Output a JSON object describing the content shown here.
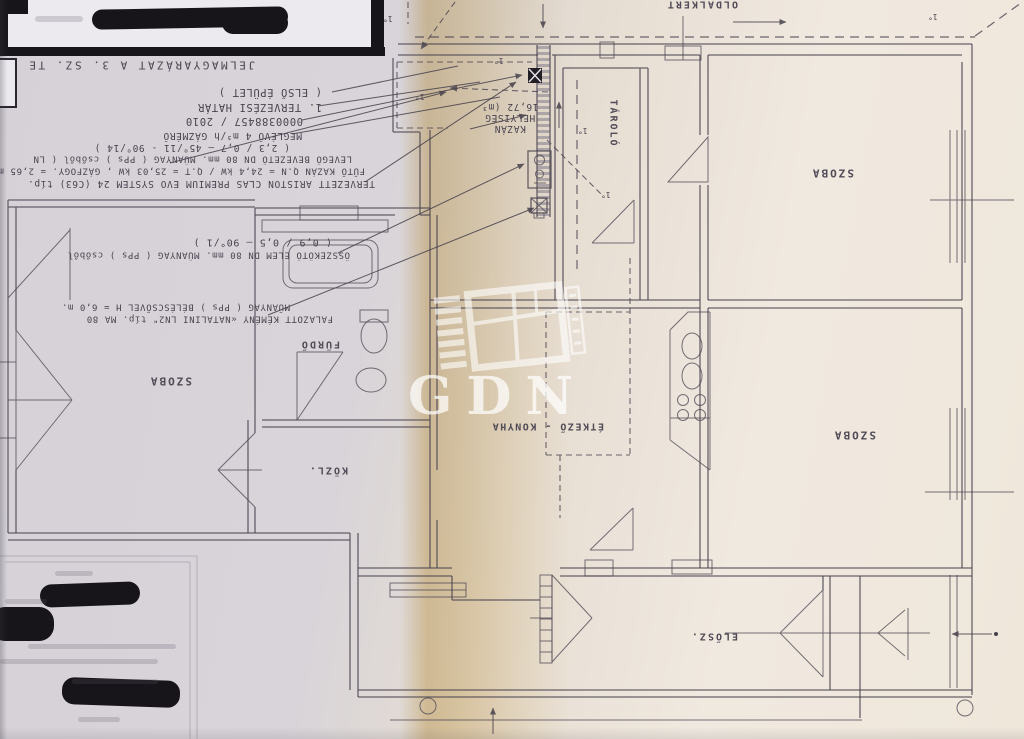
{
  "colors": {
    "paper_left": "#d8d4d9",
    "paper_right": "#f0e9e0",
    "fold_band": "#d9b468",
    "ink": "#4a4450",
    "redaction": "#17151a",
    "watermark": "#ffffff"
  },
  "legend": {
    "title": "JELMAGYARÁZAT A 3. SZ. TE",
    "lines": [
      "( ELSŐ ÉPÜLET )",
      "1. TERVEZÉSI HATÁR",
      "0000388457 / 2010",
      "MEGLÉVŐ 4 m³/h GÁZMÉRŐ",
      "( 2,3 / 0,7  –  45°/11 - 90°/14 )",
      "LEVEGŐ BEVEZETŐ DN 80 mm. MŰANYAG ( PPs ) csőből ( LN",
      "FŰTŐ KAZÁN Q.N = 24,4 kW / Q.T = 25,03 kW , GÁZFOGY. = 2,65 m",
      "TERVEZETT ARISTON CLAS PREMIUM EVO SYSTEM 24 (C63) típ.",
      "( 0,9 / 0,5  –  90°/1 )",
      "ÖSSZEKÖTŐ ELEM DN 80 mm. MŰANYAG ( PPs ) csőből",
      "MŰANYAG ( PPs ) BÉLÉSCSŐVEL  H = 6,0 m.",
      "FALAZOTT KÉMÉNY «NATALINI LN2\" típ. MA 80"
    ]
  },
  "boiler_room": {
    "line1": "KAZÁN",
    "line2": "HELYISÉG",
    "line3": "16,72 (m³"
  },
  "rooms": {
    "top_right": "SZOBA",
    "bottom_right": "SZOBA",
    "left": "SZOBA",
    "bathroom": "FÜRDŐ",
    "corridor": "KÖZL.",
    "kitchen": "ÉTKEZŐ - KONYHA",
    "hall": "ELŐSZ.",
    "storage": "TÁROLÓ"
  },
  "site": {
    "top_label": "OLDALKERT"
  },
  "watermark": {
    "text": "GDN"
  },
  "marks": {
    "degree": "1°"
  }
}
